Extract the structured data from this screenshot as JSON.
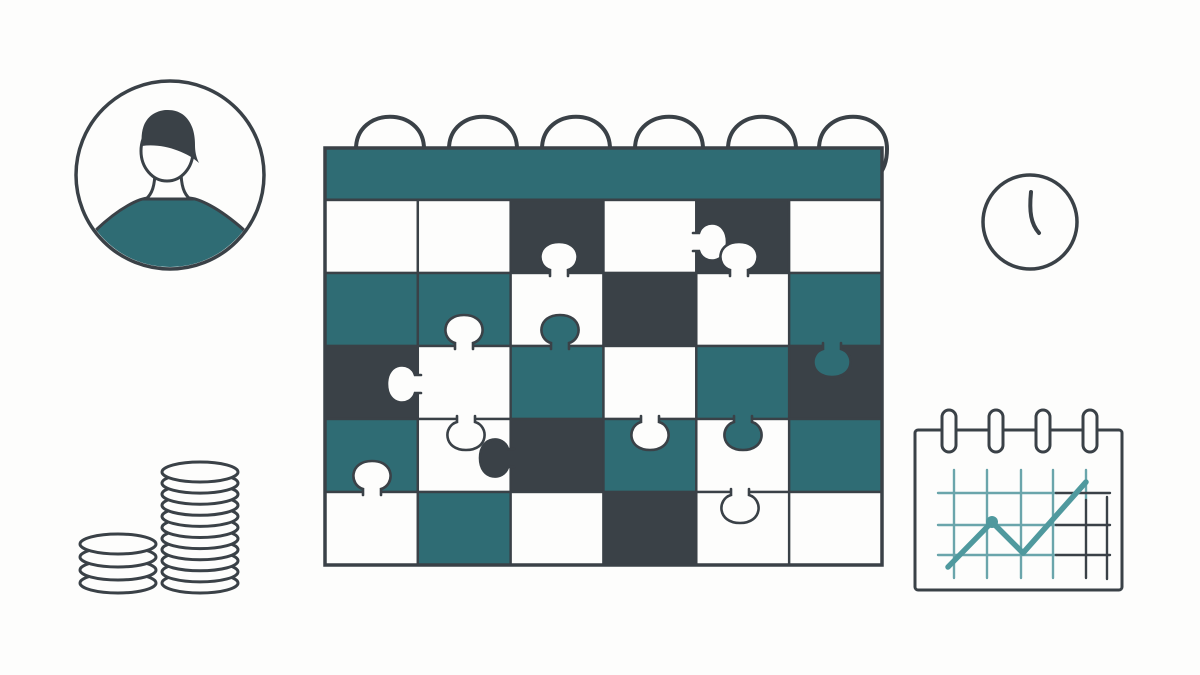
{
  "illustration": {
    "title": "planning-puzzle-illustration",
    "elements": [
      "user-avatar",
      "puzzle-calendar",
      "clock",
      "coin-stacks",
      "mini-calendar-trend-chart"
    ]
  },
  "colors": {
    "background": "#fdfdfc",
    "white": "#fdfdfc",
    "teal": "#2f6c74",
    "dark": "#3a4147",
    "outline": "#3a4147",
    "grid_teal": "#6aa5ab",
    "chart_line": "#4f999e"
  },
  "scene": {
    "avatar": {
      "shirt_color": "teal",
      "hair_color": "dark"
    },
    "puzzle_calendar": {
      "columns": 6,
      "rows": 5,
      "pattern": [
        [
          "white",
          "white",
          "dark",
          "white",
          "dark",
          "white"
        ],
        [
          "teal",
          "teal",
          "white",
          "dark",
          "white",
          "teal"
        ],
        [
          "dark",
          "white",
          "teal",
          "white",
          "teal",
          "dark"
        ],
        [
          "teal",
          "white",
          "dark",
          "teal",
          "white",
          "teal"
        ],
        [
          "white",
          "teal",
          "white",
          "dark",
          "white",
          "white"
        ]
      ],
      "rings_x": [
        390,
        483,
        576,
        669,
        762,
        853
      ],
      "knobs": [
        {
          "x": 559,
          "y": 273,
          "dir": "up",
          "fill": "white"
        },
        {
          "x": 696,
          "y": 242,
          "dir": "right",
          "fill": "white"
        },
        {
          "x": 739,
          "y": 273,
          "dir": "up",
          "fill": "white"
        },
        {
          "x": 464,
          "y": 346,
          "dir": "up",
          "fill": "white"
        },
        {
          "x": 560,
          "y": 346,
          "dir": "up",
          "fill": "teal"
        },
        {
          "x": 832,
          "y": 346,
          "dir": "down",
          "fill": "teal"
        },
        {
          "x": 418,
          "y": 384,
          "dir": "left",
          "fill": "white"
        },
        {
          "x": 466,
          "y": 419,
          "dir": "down",
          "fill": "white"
        },
        {
          "x": 650,
          "y": 419,
          "dir": "down",
          "fill": "white"
        },
        {
          "x": 743,
          "y": 419,
          "dir": "down",
          "fill": "teal"
        },
        {
          "x": 511,
          "y": 458,
          "dir": "left",
          "fill": "dark"
        },
        {
          "x": 372,
          "y": 492,
          "dir": "up",
          "fill": "white"
        },
        {
          "x": 740,
          "y": 492,
          "dir": "down",
          "fill": "white"
        }
      ]
    },
    "coins": {
      "left_stack_count": 4,
      "right_stack_count": 11
    },
    "clock": {
      "hand_position": "twelve-thirty"
    },
    "mini_calendar": {
      "ring_count": 4,
      "rings_x": [
        949,
        996,
        1043,
        1090
      ],
      "trend_points": [
        [
          948,
          567
        ],
        [
          992,
          522
        ],
        [
          1023,
          553
        ],
        [
          1086,
          482
        ]
      ],
      "peak_dot": [
        992,
        522
      ]
    }
  }
}
